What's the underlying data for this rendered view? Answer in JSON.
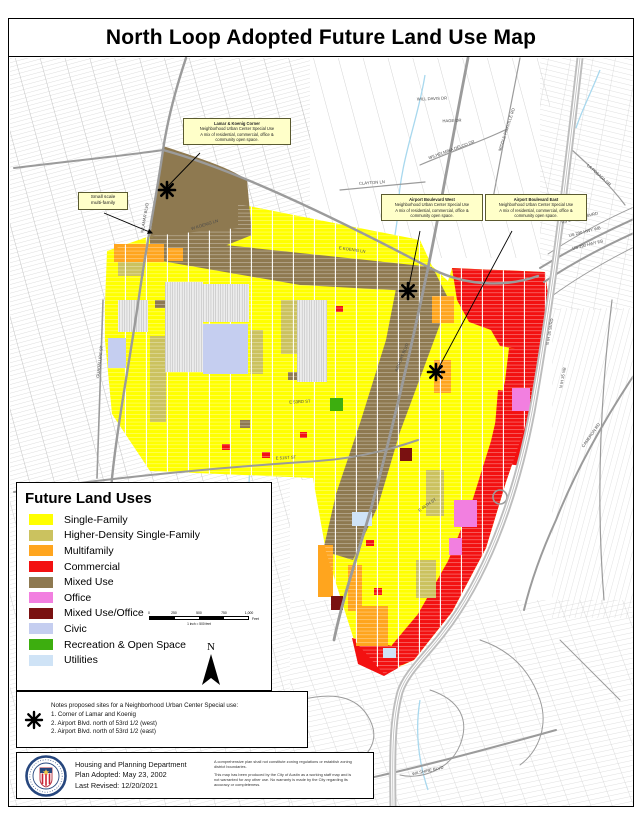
{
  "title": "North Loop Adopted Future Land Use Map",
  "colors": {
    "single_family": "#FFFF00",
    "higher_density": "#CBC25F",
    "multifamily": "#FFA51E",
    "commercial": "#F31111",
    "mixed_use": "#8E7950",
    "office": "#F27FE0",
    "mixed_use_office": "#7A1111",
    "civic": "#C5CEF0",
    "recreation": "#3DAE0F",
    "utilities": "#CFE3F6"
  },
  "legend": {
    "title": "Future Land Uses",
    "items": [
      {
        "label": "Single-Family",
        "color_key": "single_family"
      },
      {
        "label": "Higher-Density Single-Family",
        "color_key": "higher_density"
      },
      {
        "label": "Multifamily",
        "color_key": "multifamily"
      },
      {
        "label": "Commercial",
        "color_key": "commercial"
      },
      {
        "label": "Mixed Use",
        "color_key": "mixed_use"
      },
      {
        "label": "Office",
        "color_key": "office"
      },
      {
        "label": "Mixed Use/Office",
        "color_key": "mixed_use_office"
      },
      {
        "label": "Civic",
        "color_key": "civic"
      },
      {
        "label": "Recreation & Open Space",
        "color_key": "recreation"
      },
      {
        "label": "Utilities",
        "color_key": "utilities"
      }
    ]
  },
  "scale_bar": {
    "ticks": [
      "0",
      "250",
      "500",
      "750",
      "1,000"
    ],
    "unit": "Feet",
    "ratio": "1 inch = 500 feet"
  },
  "north_label": "N",
  "callouts": [
    {
      "id": "small-multifamily",
      "lines": [
        "Small scale",
        "multi-family"
      ]
    },
    {
      "id": "lamar-koenig",
      "lines": [
        "Lamar & Koenig Corner",
        "Neighborhood Urban Center Special Use",
        "A mix of residential, commercial, office &",
        "community open space."
      ]
    },
    {
      "id": "airport-west",
      "lines": [
        "Airport Boulevard West",
        "Neighborhood Urban Center Special Use",
        "A mix of residential, commercial, office &",
        "community open space."
      ]
    },
    {
      "id": "airport-east",
      "lines": [
        "Airport Boulevard East",
        "Neighborhood Urban Center Special Use",
        "A mix of residential, commercial, office &",
        "community open space."
      ]
    }
  ],
  "notes": {
    "heading": "Notes proposed sites for a Neighborhood Urban Center Special use:",
    "items": [
      "1. Corner of Lamar and Koenig",
      "2. Airport Blvd. north of 53rd 1/2 (west)",
      "2. Airport Blvd. north of 53rd 1/2 (east)"
    ]
  },
  "footer": {
    "department": "Housing and Planning Department",
    "adopted": "Plan Adopted: May 23, 2002",
    "revised": "Last Revised: 12/20/2021",
    "disclaimer1": "A comprehensive plan shall not constitute zoning regulations or establish zoning district boundaries.",
    "disclaimer2": "This map has been produced by the City of Austin as a working staff map and is not warranted for any other use. No warranty is made by the City regarding its accuracy or completeness."
  },
  "street_labels": [
    {
      "text": "W KOENIG LN",
      "x": 205,
      "y": 226,
      "rot": -17
    },
    {
      "text": "E KOENIG LN",
      "x": 352,
      "y": 251,
      "rot": 8
    },
    {
      "text": "N LAMAR BLVD",
      "x": 146,
      "y": 218,
      "rot": -80
    },
    {
      "text": "AIRPORT BLVD",
      "x": 403,
      "y": 358,
      "rot": -68
    },
    {
      "text": "N IH 35 SVRD",
      "x": 551,
      "y": 332,
      "rot": -80
    },
    {
      "text": "N IH 35 NB",
      "x": 564,
      "y": 378,
      "rot": -80
    },
    {
      "text": "E 51ST ST",
      "x": 286,
      "y": 459,
      "rot": -3
    },
    {
      "text": "E 53RD ST",
      "x": 300,
      "y": 403,
      "rot": -3
    },
    {
      "text": "CAMERON RD",
      "x": 592,
      "y": 436,
      "rot": -55
    },
    {
      "text": "WILSHIRE BLVD",
      "x": 428,
      "y": 772,
      "rot": -12
    },
    {
      "text": "MIDDLE FISKVILLE RD",
      "x": 508,
      "y": 130,
      "rot": -72
    },
    {
      "text": "LA POSADA DR",
      "x": 598,
      "y": 176,
      "rot": 42
    },
    {
      "text": "CLAYTON LN",
      "x": 372,
      "y": 184,
      "rot": -4
    },
    {
      "text": "WILHELMINA DELCO DR",
      "x": 452,
      "y": 151,
      "rot": -20
    },
    {
      "text": "US 290 HWY SVRD",
      "x": 580,
      "y": 219,
      "rot": -14
    },
    {
      "text": "US 290 HWY WB",
      "x": 585,
      "y": 233,
      "rot": -14
    },
    {
      "text": "US 290 HWY EB",
      "x": 588,
      "y": 246,
      "rot": -14
    },
    {
      "text": "GUADALUPE ST",
      "x": 101,
      "y": 362,
      "rot": -83
    },
    {
      "text": "E 46TH ST",
      "x": 428,
      "y": 506,
      "rot": -35
    },
    {
      "text": "WILL DAVIS DR",
      "x": 432,
      "y": 100,
      "rot": -2
    },
    {
      "text": "HAGE DR",
      "x": 452,
      "y": 122,
      "rot": -2
    }
  ]
}
